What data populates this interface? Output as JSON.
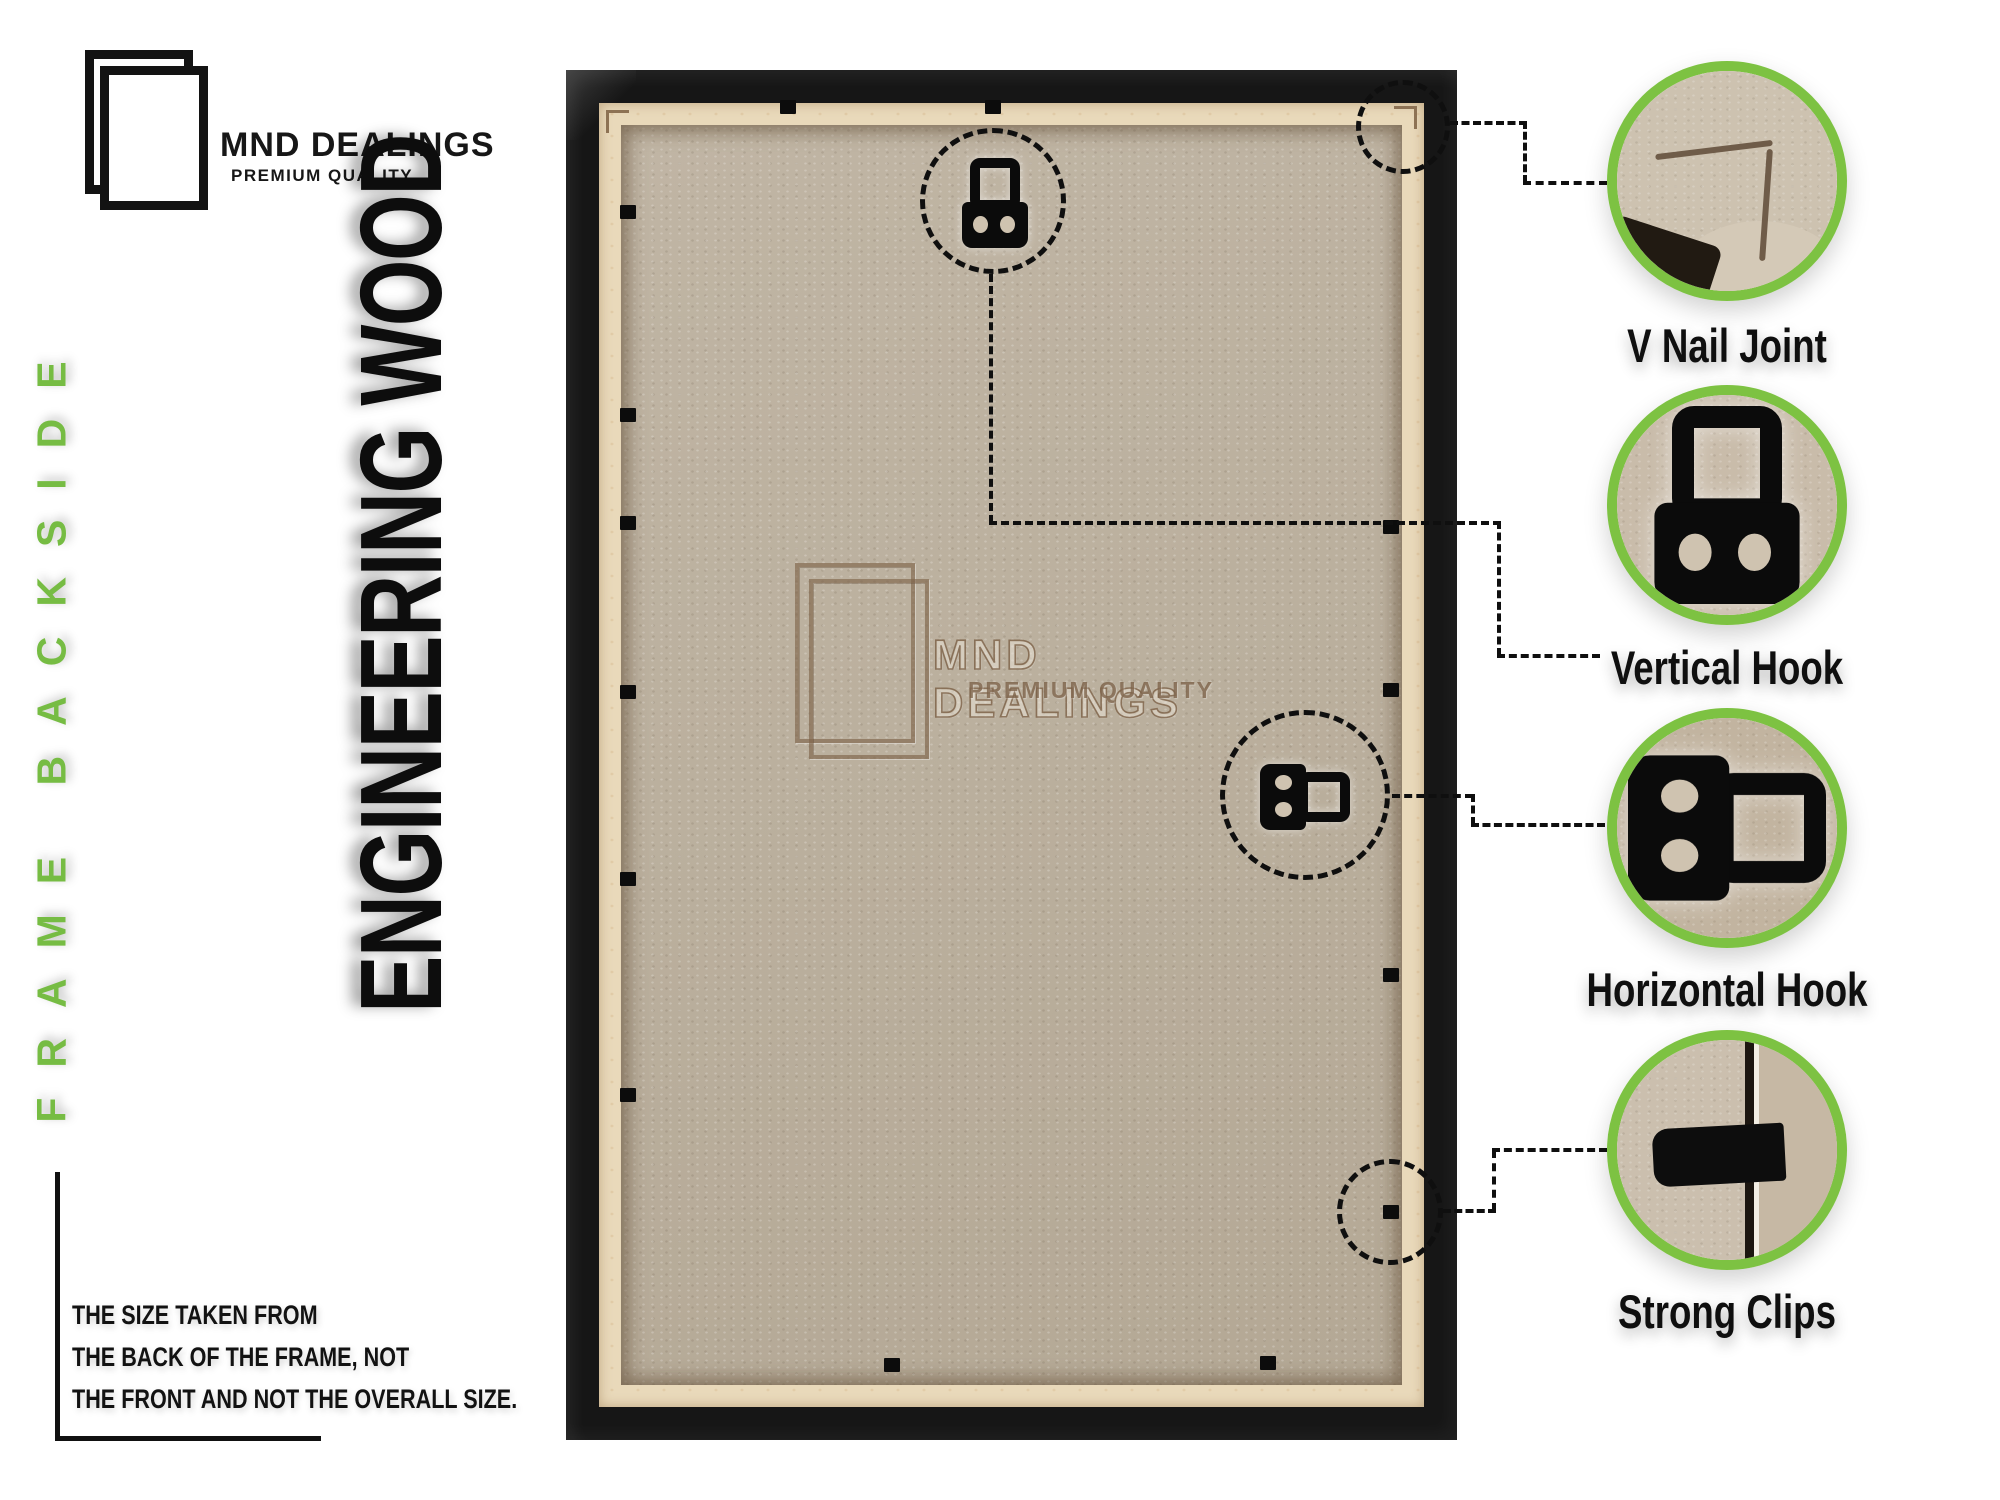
{
  "brand": {
    "name": "MND DEALINGS",
    "tagline": "PREMIUM QUALITY"
  },
  "side_label": "FRAME BACKSIDE",
  "material_label": "ENGINEERING WOOD",
  "size_note": {
    "lines": [
      "THE SIZE TAKEN FROM",
      "THE BACK OF THE FRAME, NOT",
      "THE FRONT AND NOT THE OVERALL SIZE."
    ]
  },
  "watermark": {
    "name": "MND DEALINGS",
    "tagline": "PREMIUM QUALITY"
  },
  "callouts": [
    {
      "id": "v-nail-joint",
      "label": "V Nail Joint"
    },
    {
      "id": "vertical-hook",
      "label": "Vertical Hook"
    },
    {
      "id": "horizontal-hook",
      "label": "Horizontal Hook"
    },
    {
      "id": "strong-clips",
      "label": "Strong Clips"
    }
  ],
  "colors": {
    "accent_green": "#7DC242",
    "frame_black": "#161616",
    "mdf_tan": "#BCB1A0",
    "cream_edge": "#E9D9BA",
    "text_black": "#111111",
    "watermark_brown": "#7A5F45"
  }
}
